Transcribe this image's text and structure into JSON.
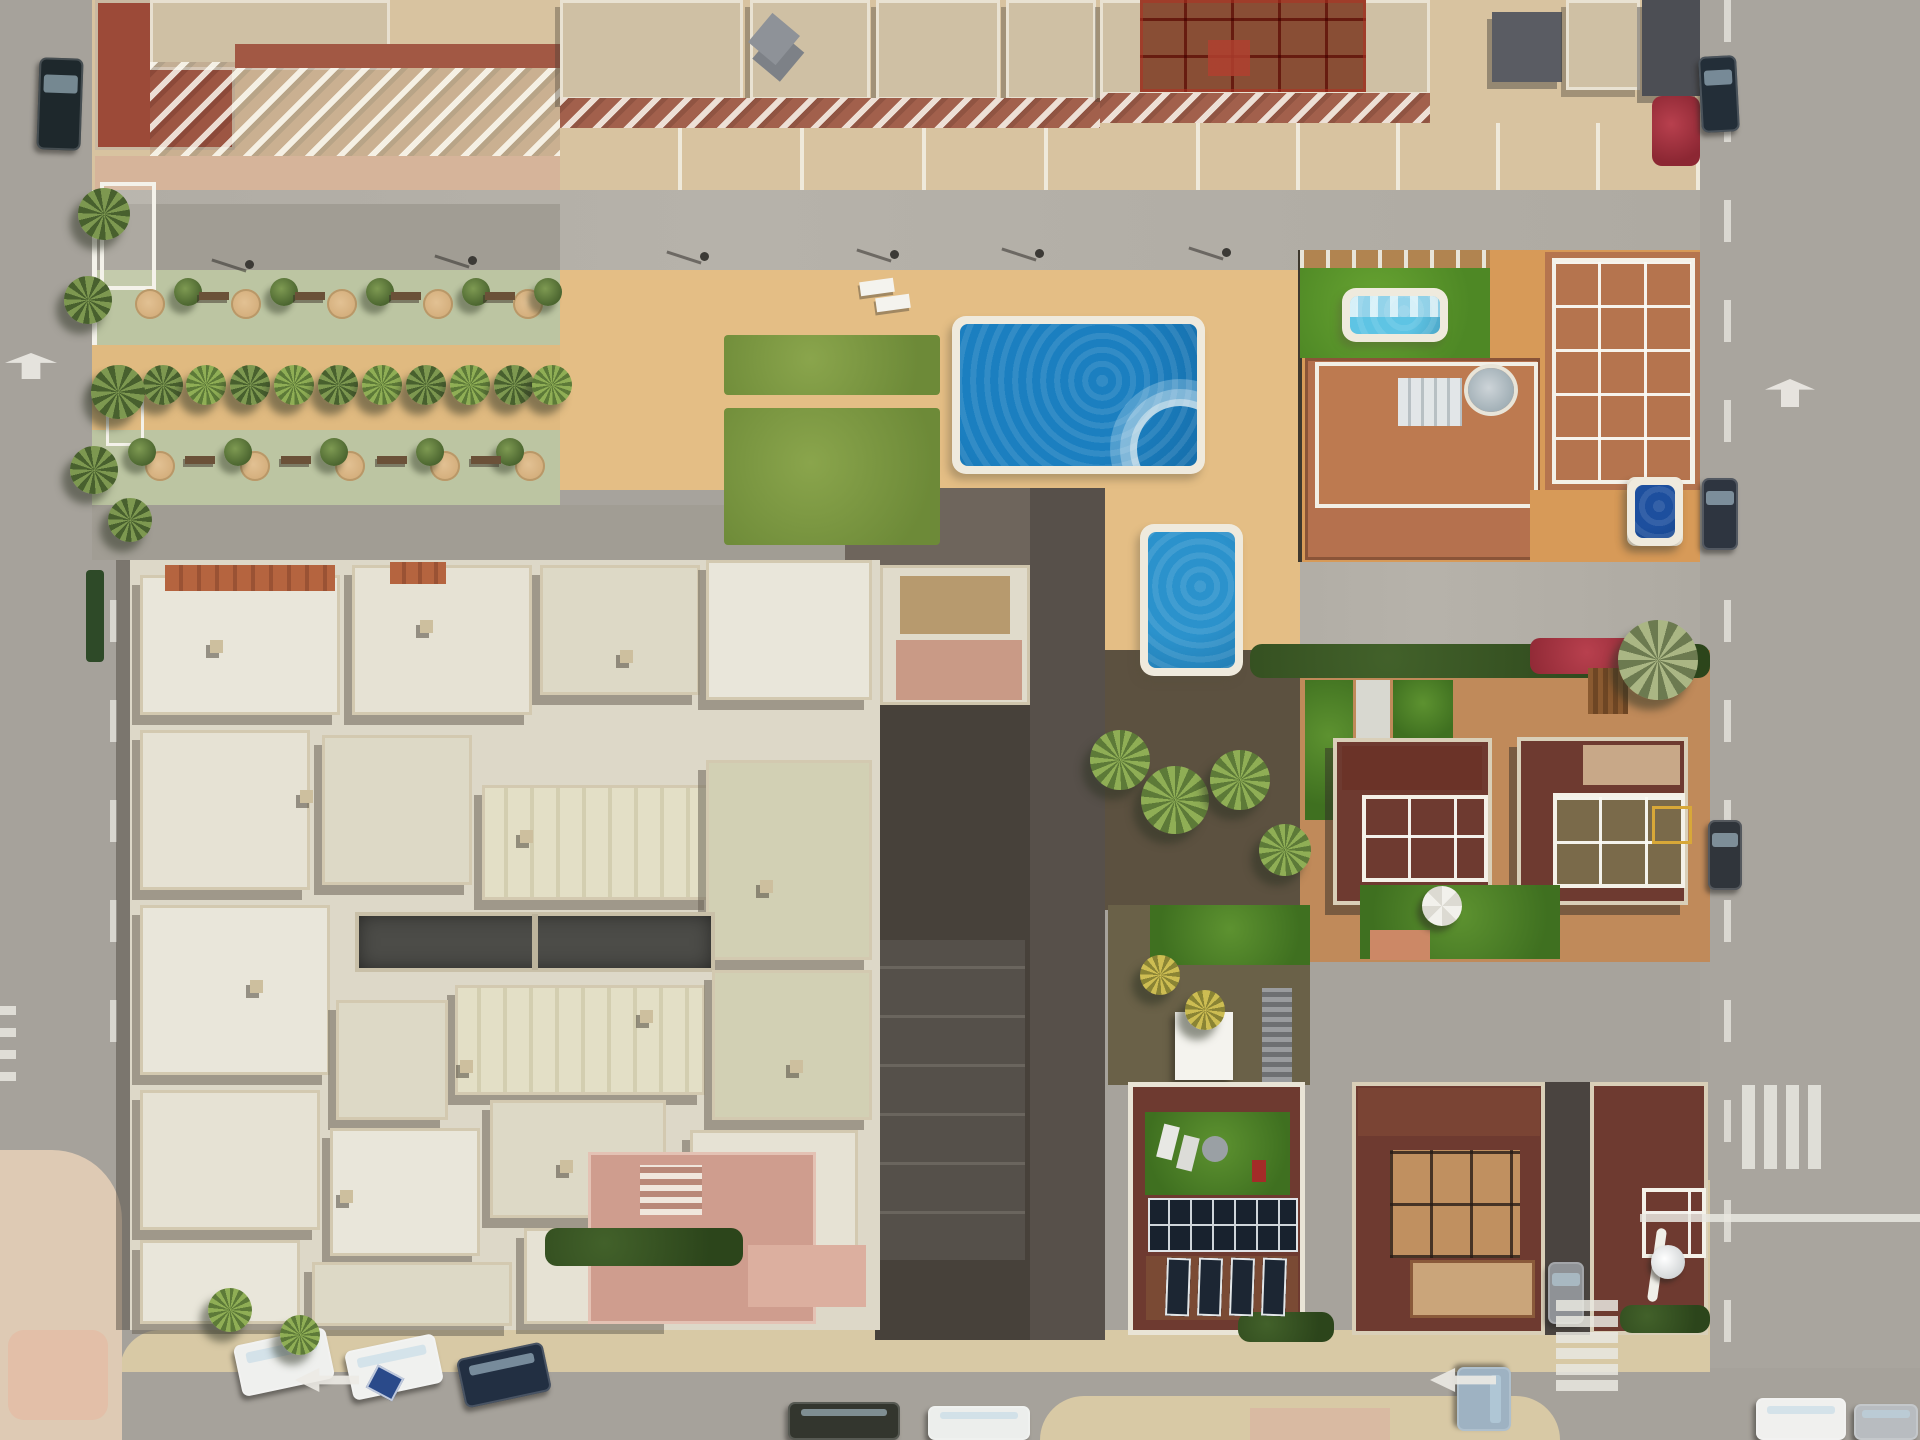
{
  "scene": {
    "title": "Aerial top-down view of a coastal Spanish residential block",
    "description": "Drone photo: apartment buildings with terracotta balconies at top, palm-lined promenade on the left, community pools in the center, a large white multi-roof complex lower-left, terracotta villas with rooftop terraces and gardens on the right, gray streets with parked cars and road markings framing the block.",
    "sun_direction": "northeast",
    "view": "orthographic top-down"
  },
  "palette": {
    "asphalt": "#a6a29b",
    "sidewalk_tan": "#d8c9a5",
    "deck_sand": "#e4be85",
    "pool_water": "#1b7fc0",
    "small_pool_water": "#2b92cc",
    "covered_pool": "#5ec4e4",
    "dark_pool": "#1d4f9e",
    "lawn_green": "#5a9428",
    "promenade_green": "#bcc5a2",
    "white_roof": "#e6e2d4",
    "terracotta": "#a25844",
    "villa_maroon": "#6e3a30",
    "hedge_green": "#2c451b",
    "bougainvillea": "#a52f3a",
    "gray_roof": "#5a5c63"
  },
  "pools": [
    {
      "name": "main-community-pool",
      "x": 952,
      "y": 316,
      "w": 253,
      "h": 158,
      "water": "#1b7fc0",
      "steps": true
    },
    {
      "name": "small-community-pool",
      "x": 1140,
      "y": 524,
      "w": 103,
      "h": 152,
      "water": "#2b92cc",
      "steps": false
    },
    {
      "name": "villa-covered-pool",
      "x": 1342,
      "y": 288,
      "w": 106,
      "h": 54,
      "water": "#5ec4e4",
      "steps": false,
      "cover": true
    },
    {
      "name": "villa-dark-pool",
      "x": 1627,
      "y": 477,
      "w": 56,
      "h": 69,
      "water": "#1d4f9e",
      "steps": false
    }
  ],
  "cars": [
    {
      "name": "car-dark-top-left",
      "x": 38,
      "y": 58,
      "w": 44,
      "h": 92,
      "color": "#1e282c",
      "rot": 2
    },
    {
      "name": "car-right-road-top",
      "x": 1700,
      "y": 56,
      "w": 38,
      "h": 76,
      "color": "#232e38",
      "rot": -3
    },
    {
      "name": "car-right-road-mid",
      "x": 1702,
      "y": 478,
      "w": 36,
      "h": 72,
      "color": "#2e3540",
      "rot": 0
    },
    {
      "name": "car-right-road-low",
      "x": 1708,
      "y": 820,
      "w": 34,
      "h": 70,
      "color": "#30353b",
      "rot": 0
    },
    {
      "name": "car-parked-white-1",
      "x": 237,
      "y": 1336,
      "w": 94,
      "h": 52,
      "color": "#eff0ee",
      "rot": -12
    },
    {
      "name": "car-parked-white-2",
      "x": 348,
      "y": 1342,
      "w": 92,
      "h": 50,
      "color": "#f0f1ef",
      "rot": -12
    },
    {
      "name": "car-parked-blue",
      "x": 460,
      "y": 1350,
      "w": 88,
      "h": 50,
      "color": "#222f42",
      "rot": -12
    },
    {
      "name": "car-bottom-olive",
      "x": 788,
      "y": 1402,
      "w": 112,
      "h": 38,
      "color": "#33362e",
      "rot": 0
    },
    {
      "name": "car-bottom-white",
      "x": 928,
      "y": 1406,
      "w": 102,
      "h": 34,
      "color": "#eceeec",
      "rot": 0
    },
    {
      "name": "car-junction-silver-blue",
      "x": 1452,
      "y": 1372,
      "w": 64,
      "h": 54,
      "color": "#9eb2c2",
      "rot": 90
    },
    {
      "name": "car-driveway-silver",
      "x": 1548,
      "y": 1262,
      "w": 36,
      "h": 62,
      "color": "#8f9296",
      "rot": 0
    },
    {
      "name": "car-bottom-right-white",
      "x": 1756,
      "y": 1398,
      "w": 90,
      "h": 42,
      "color": "#f0f0ee",
      "rot": 0
    },
    {
      "name": "car-bottom-right-silver",
      "x": 1854,
      "y": 1404,
      "w": 64,
      "h": 36,
      "color": "#b8bcc0",
      "rot": 0
    }
  ],
  "promenade": {
    "palm_row_y": 385,
    "palm_row_x": [
      120,
      163,
      206,
      250,
      294,
      338,
      382,
      426,
      470,
      514,
      552
    ],
    "left_palms": [
      [
        104,
        214,
        26
      ],
      [
        88,
        300,
        24
      ],
      [
        118,
        392,
        27
      ],
      [
        94,
        470,
        24
      ],
      [
        130,
        520,
        22
      ]
    ],
    "planters_row1": {
      "y": 304,
      "x": [
        150,
        246,
        342,
        438,
        528
      ]
    },
    "planters_row2": {
      "y": 466,
      "x": [
        160,
        255,
        350,
        445,
        530
      ]
    },
    "olive_row1": {
      "y": 292,
      "x": [
        188,
        284,
        380,
        476,
        548
      ]
    },
    "olive_row2": {
      "y": 452,
      "x": [
        142,
        238,
        334,
        430,
        510
      ]
    },
    "benches_row1": {
      "y": 296,
      "x": [
        214,
        310,
        406,
        500
      ]
    },
    "benches_row2": {
      "y": 460,
      "x": [
        200,
        296,
        392,
        486
      ]
    }
  },
  "deck": {
    "lamps": [
      [
        700,
        252
      ],
      [
        890,
        250
      ],
      [
        1035,
        249
      ],
      [
        1222,
        248
      ],
      [
        245,
        260
      ],
      [
        468,
        256
      ]
    ],
    "loungers": [
      [
        860,
        280
      ],
      [
        876,
        296
      ]
    ],
    "grass_patches": [
      [
        724,
        335,
        216,
        60
      ],
      [
        724,
        408,
        216,
        137
      ]
    ]
  },
  "villas": {
    "cluster_palms": [
      [
        1120,
        760,
        30
      ],
      [
        1175,
        800,
        34
      ],
      [
        1240,
        780,
        30
      ],
      [
        1285,
        850,
        26
      ],
      [
        230,
        1310,
        22
      ],
      [
        300,
        1335,
        20
      ]
    ],
    "garden_palms_yellow": [
      [
        1160,
        975,
        22
      ],
      [
        1205,
        1010,
        20
      ]
    ],
    "silver_palm": [
      1658,
      660,
      40
    ],
    "umbrella": {
      "x": 1442,
      "y": 906,
      "r": 20,
      "color": "#f2f1ec"
    },
    "satellite_dish": {
      "x": 1668,
      "y": 1262,
      "r": 17
    },
    "solar_array": {
      "x": 1148,
      "y": 1198,
      "w": 150,
      "h": 54
    },
    "solar_small_panels": [
      [
        1166,
        1258
      ],
      [
        1198,
        1258
      ],
      [
        1230,
        1258
      ],
      [
        1262,
        1258
      ]
    ]
  },
  "markings": {
    "arrows": [
      {
        "name": "arrow-left-road-up",
        "x": 18,
        "y": 340,
        "w": 26,
        "h": 52,
        "rot": 90
      },
      {
        "name": "arrow-right-road-up",
        "x": 1776,
        "y": 368,
        "w": 28,
        "h": 50,
        "rot": 90
      },
      {
        "name": "arrow-bottom-left",
        "x": 295,
        "y": 1368,
        "w": 64,
        "h": 24,
        "rot": 0
      },
      {
        "name": "arrow-bottom-right",
        "x": 1430,
        "y": 1368,
        "w": 66,
        "h": 24,
        "rot": 0
      }
    ],
    "zebra": {
      "x": 1556,
      "y": 1300,
      "bar_w": 62,
      "bar_h": 11,
      "gap": 5,
      "count": 6
    },
    "giveway": {
      "x": 1742,
      "y": 1085,
      "bar_w": 13,
      "bar_h": 84,
      "gap": 9,
      "count": 4
    },
    "left_edge_bars": {
      "x": 0,
      "y": 1006,
      "bar_w": 16,
      "bar_h": 9,
      "gap": 13,
      "count": 4
    },
    "stop_line": {
      "x": 1640,
      "y": 1214,
      "w": 280,
      "h": 8
    },
    "banner_blue": {
      "x": 370,
      "y": 1370,
      "w": 30,
      "h": 26,
      "color": "#2a4a8a"
    }
  },
  "chimneys": [
    [
      210,
      640
    ],
    [
      420,
      620
    ],
    [
      620,
      650
    ],
    [
      300,
      790
    ],
    [
      520,
      830
    ],
    [
      250,
      980
    ],
    [
      460,
      1060
    ],
    [
      640,
      1010
    ],
    [
      340,
      1190
    ],
    [
      560,
      1160
    ],
    [
      760,
      880
    ],
    [
      790,
      1060
    ]
  ]
}
